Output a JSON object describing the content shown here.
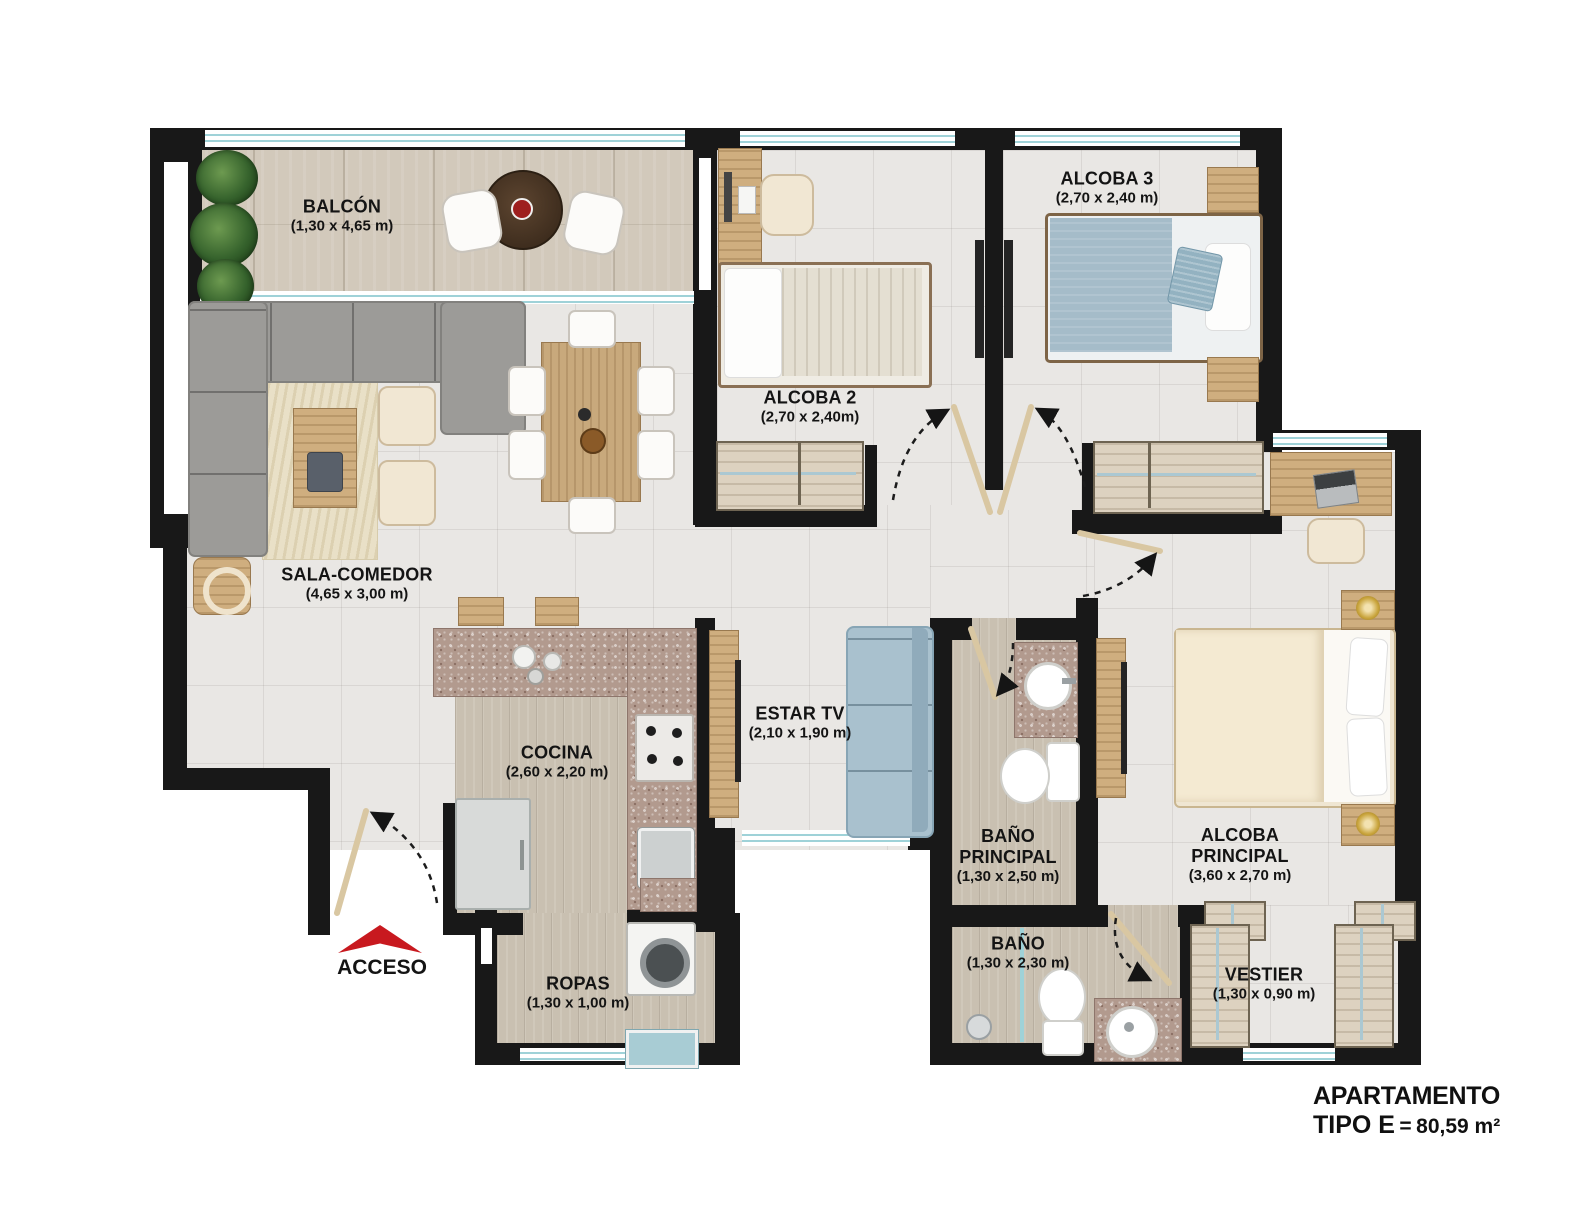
{
  "plan": {
    "rooms": {
      "balcon": {
        "name": "BALCÓN",
        "dims": "(1,30 x 4,65 m)"
      },
      "sala": {
        "name": "SALA-COMEDOR",
        "dims": "(4,65 x 3,00 m)"
      },
      "cocina": {
        "name": "COCINA",
        "dims": "(2,60 x 2,20 m)"
      },
      "estar": {
        "name": "ESTAR TV",
        "dims": "(2,10 x 1,90 m)"
      },
      "alcoba2": {
        "name": "ALCOBA 2",
        "dims": "(2,70 x 2,40m)"
      },
      "alcoba3": {
        "name": "ALCOBA 3",
        "dims": "(2,70 x 2,40 m)"
      },
      "alcobaPrincipal": {
        "name": "ALCOBA PRINCIPAL",
        "dims": "(3,60 x 2,70 m)"
      },
      "banoPrincipal": {
        "name": "BAÑO PRINCIPAL",
        "dims": "(1,30 x 2,50 m)"
      },
      "bano": {
        "name": "BAÑO",
        "dims": "(1,30 x 2,30 m)"
      },
      "vestier": {
        "name": "VESTIER",
        "dims": "(1,30 x 0,90 m)"
      },
      "ropas": {
        "name": "ROPAS",
        "dims": "(1,30 x 1,00 m)"
      }
    },
    "access": {
      "label": "ACCESO"
    },
    "title": {
      "line1": "APARTAMENTO",
      "line2": "TIPO E",
      "equals": "=",
      "area": "80,59 m²"
    },
    "colors": {
      "wall": "#181818",
      "accent_red": "#c8191f",
      "window_blue": "#9fd2d8",
      "granite": "#b29a8e"
    }
  }
}
